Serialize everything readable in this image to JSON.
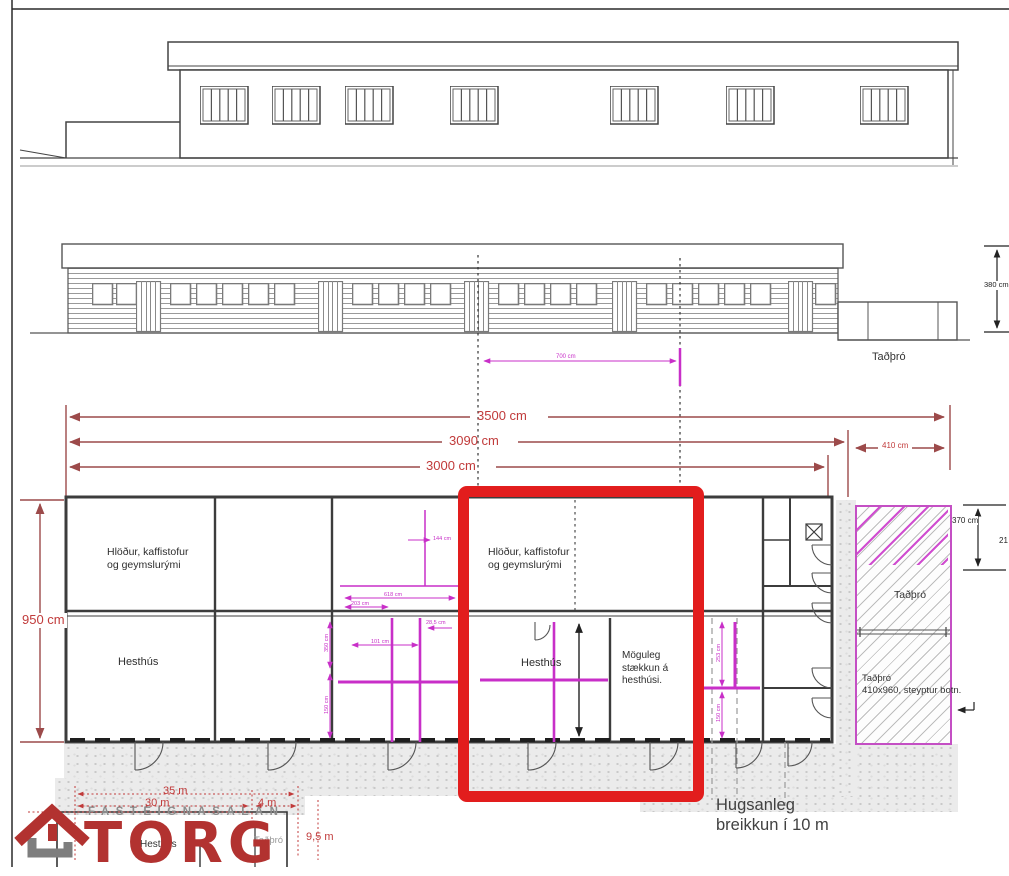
{
  "colors": {
    "dim_red_line": "#9c4a4a",
    "dim_red_text": "#c13b3b",
    "magenta": "#c82fc8",
    "highlight_red": "#e21d1d",
    "drawing_line": "#3c3c3c",
    "logo_red": "#b23230",
    "logo_gray": "#8c8c8c"
  },
  "elevations": {
    "front": {
      "tadbro_label": "Taðþró",
      "height_dim": "380 cm",
      "width_dim_magenta": "700 cm"
    }
  },
  "dimensions": {
    "total_width": "3500 cm",
    "building_with_extension": "3090 cm",
    "building_width": "3000 cm",
    "tadbro_width": "410 cm",
    "building_depth": "950 cm",
    "tadbro_depth": "370 cm",
    "tadbro_partial": "21"
  },
  "plan": {
    "barn_left_line1": "Hlöður, kaffistofur",
    "barn_left_line2": "og geymslurými",
    "barn_mid_line1": "Hlöður, kaffistofur",
    "barn_mid_line2": "og geymslurými",
    "stable_left": "Hesthús",
    "stable_mid": "Hesthús",
    "extension_line1": "Möguleg",
    "extension_line2": "stækkun á",
    "extension_line3": "hesthúsi.",
    "tadbro": "Taðþró",
    "tadbro_note_line1": "Taðþró",
    "tadbro_note_line2": "410x960, steyptur botn.",
    "small_dims": {
      "a": "350 cm",
      "b": "150 cm",
      "c": "618 cm",
      "d": "203 cm",
      "e": "101 cm",
      "f": "28,5 cm",
      "g": "144 cm",
      "h": "253 cm",
      "i": "150 cm"
    }
  },
  "annotation": {
    "line1": "Hugsanleg",
    "line2": "breikkun í 10 m"
  },
  "sketch": {
    "dim_35": "35 m",
    "dim_30": "30 m",
    "dim_4": "4 m",
    "dim_95": "9,5 m",
    "stable": "Hesthús",
    "tadbro": "Taðþró"
  },
  "logo": {
    "tagline": "FASTEIGNASALAN",
    "name": "TORG"
  }
}
